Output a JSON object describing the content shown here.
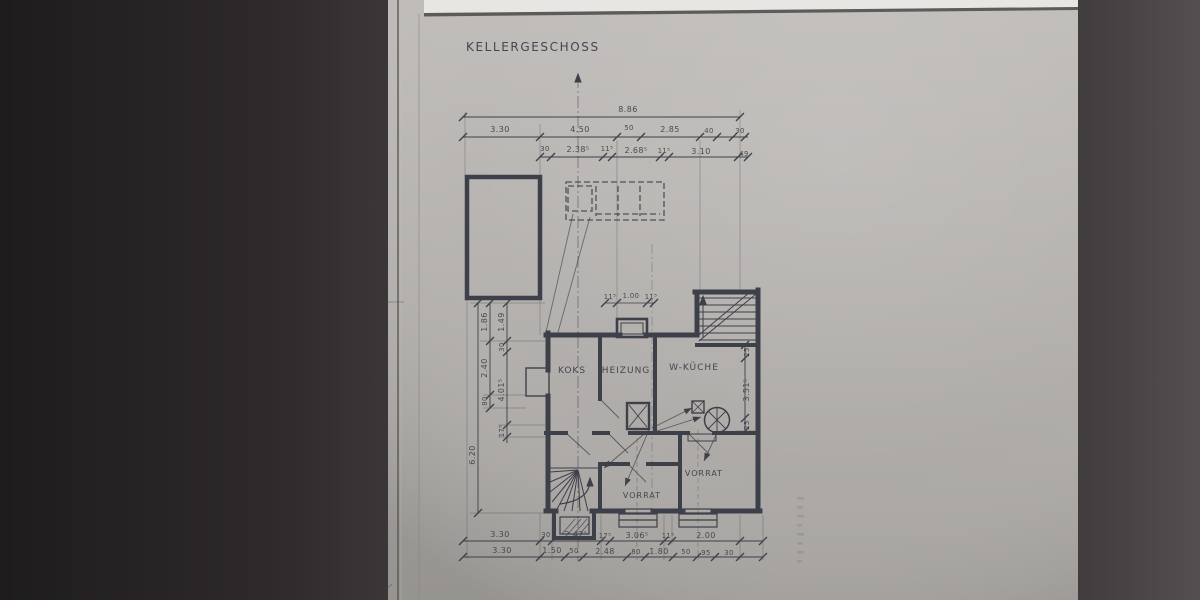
{
  "title": "KELLERGESCHOSS",
  "rooms": {
    "koks": "KOKS",
    "heizung": "HEIZUNG",
    "wkueche": "W-KÜCHE",
    "vorrat_right": "VORRAT",
    "vorrat_center": "VORRAT"
  },
  "dimensions": {
    "overall_width": "8.86",
    "top_row_2": [
      "3.30",
      "4.50",
      "50",
      "2.85",
      "40",
      "30"
    ],
    "top_row_3": [
      "30",
      "2.38⁵",
      "11⁵",
      "2.68⁵",
      "11⁵",
      "3.10",
      "49"
    ],
    "niche_row": [
      "11⁵",
      "1.00",
      "11⁵"
    ],
    "left_outer": "6.20",
    "left_mid": [
      "1.86",
      "2.40",
      "80"
    ],
    "left_inner": [
      "1.49",
      "30",
      "4.01⁵",
      "17⁵"
    ],
    "right_side": [
      "25",
      "3.51⁵",
      "25"
    ],
    "bottom_row_1": [
      "3.30",
      "30",
      "2.42⁵",
      "17⁵",
      "3.06⁵",
      "11⁵",
      "2.00"
    ],
    "bottom_row_2": [
      "3.30",
      "1.50",
      "50",
      "2.48",
      "80",
      "1.80",
      "50",
      "95",
      "30"
    ]
  },
  "colors": {
    "paper": "#b5b2af",
    "ink": "#3e4049",
    "background_left": "#262223",
    "background_right": "#4a4647",
    "paper_top_strip": "#e7e6e3"
  }
}
